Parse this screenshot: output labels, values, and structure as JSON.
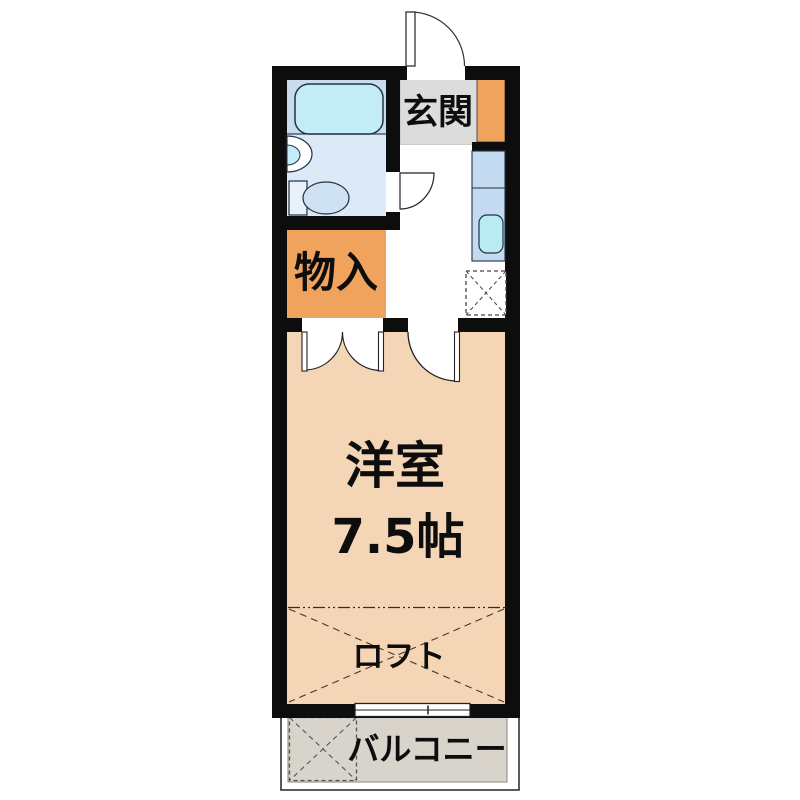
{
  "plan": {
    "type": "apartment-floor-plan",
    "labels": {
      "entrance": "玄関",
      "closet": "物入",
      "room_name": "洋室",
      "room_size": "7.5帖",
      "loft": "ロフト",
      "balcony": "バルコニー"
    },
    "rooms": [
      {
        "name": "entrance-genkan",
        "label": "玄関"
      },
      {
        "name": "bathroom-unit",
        "fixtures": [
          "bathtub",
          "wash-basin",
          "toilet"
        ]
      },
      {
        "name": "kitchen-hallway",
        "fixtures": [
          "kitchen-counter",
          "kitchen-sink",
          "refrigerator-space",
          "shoe-cabinet"
        ]
      },
      {
        "name": "storage-closet",
        "label": "物入"
      },
      {
        "name": "western-room",
        "label": "洋室",
        "size": "7.5帖"
      },
      {
        "name": "loft-area",
        "label": "ロフト"
      },
      {
        "name": "balcony",
        "label": "バルコニー",
        "fixtures": [
          "washer-space"
        ]
      }
    ],
    "colors": {
      "wall": "#0d0d0d",
      "room_floor": "#f4d5b5",
      "closet_fill": "#f0a35c",
      "shoe_cabinet_fill": "#f0a35c",
      "entrance_floor": "#dcdcdc",
      "bathroom_floor": "#dce9f6",
      "bathtub_zone": "#c9dcee",
      "bathtub_fill": "#c3ecf6",
      "toilet_fill": "#cfe2f4",
      "kitchen_counter": "#c3daf0",
      "kitchen_sink_fill": "#b9ecf2",
      "balcony_floor": "#d8d4cb",
      "background": "#ffffff"
    }
  }
}
